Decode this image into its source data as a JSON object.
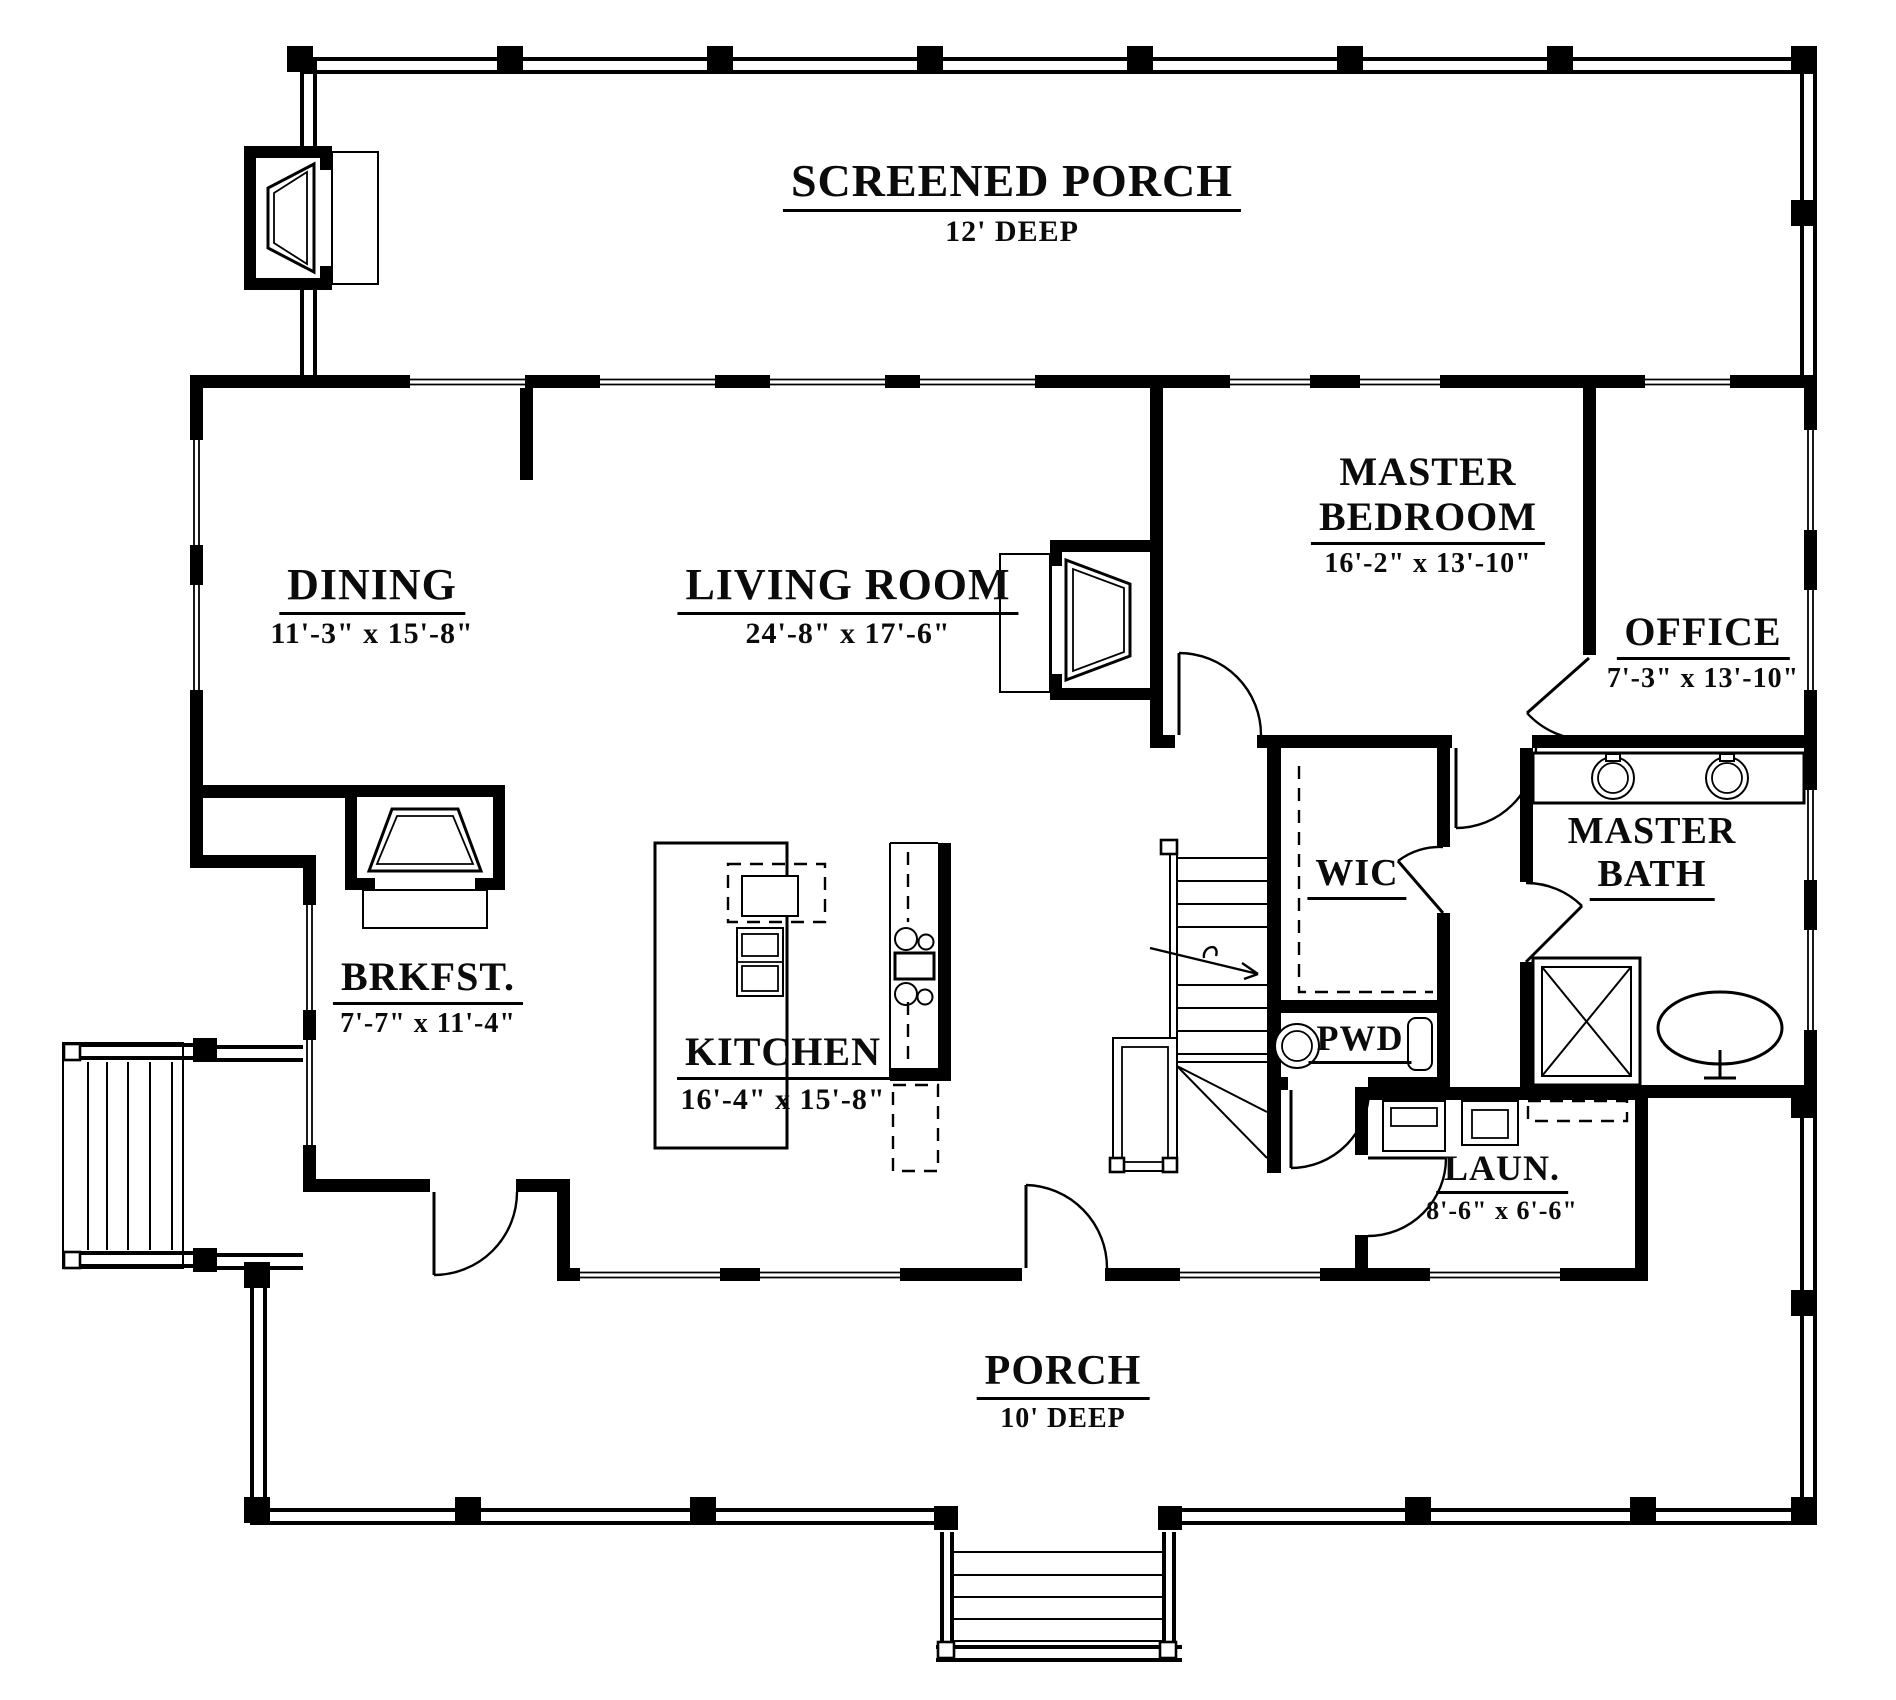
{
  "rooms": {
    "screened_porch": {
      "name": "SCREENED PORCH",
      "dims": "12' DEEP"
    },
    "dining": {
      "name": "DINING",
      "dims": "11'-3\" x 15'-8\""
    },
    "living_room": {
      "name": "LIVING ROOM",
      "dims": "24'-8\" x 17'-6\""
    },
    "master_bedroom": {
      "line1": "MASTER",
      "line2": "BEDROOM",
      "dims": "16'-2\" x 13'-10\""
    },
    "office": {
      "name": "OFFICE",
      "dims": "7'-3\" x 13'-10\""
    },
    "wic": {
      "name": "WIC"
    },
    "master_bath": {
      "line1": "MASTER",
      "line2": "BATH"
    },
    "brkfst": {
      "name": "BRKFST.",
      "dims": "7'-7\" x 11'-4\""
    },
    "kitchen": {
      "name": "KITCHEN",
      "dims": "16'-4\" x 15'-8\""
    },
    "pwd": {
      "name": "PWD"
    },
    "laundry": {
      "name": "LAUN.",
      "dims": "8'-6\" x 6'-6\""
    },
    "porch": {
      "name": "PORCH",
      "dims": "10' DEEP"
    }
  },
  "colors": {
    "ink": "#000000",
    "paper": "#ffffff"
  }
}
